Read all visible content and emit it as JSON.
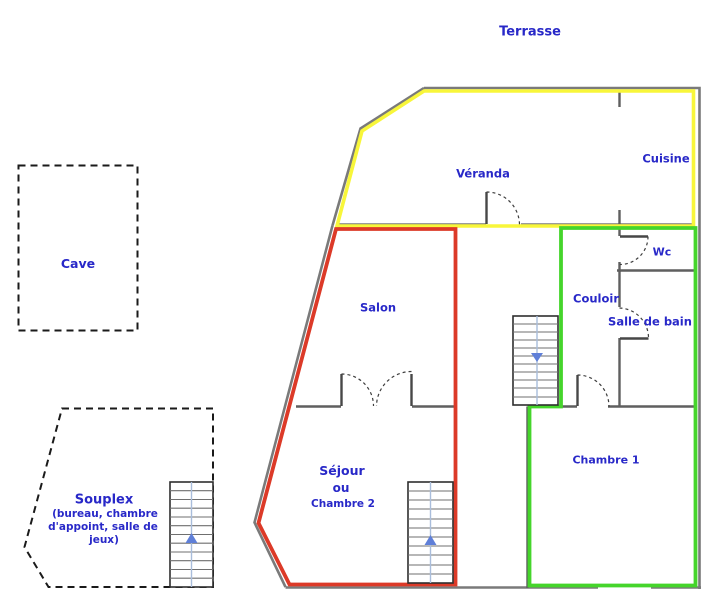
{
  "title": "Plan d'étage (floor plan)",
  "colors": {
    "label_blue": "#2828c8",
    "zone_yellow": "#f8f63a",
    "zone_red": "#dc3a28",
    "zone_green": "#45d52b",
    "wall_gray": "#7a7a7a",
    "dash_black": "#1a1a1a",
    "arrow_blue": "#5f7fd8"
  },
  "labels": {
    "terrasse": "Terrasse",
    "cave": "Cave",
    "veranda": "Véranda",
    "cuisine": "Cuisine",
    "wc": "Wc",
    "couloir": "Couloir",
    "salle_de_bain": "Salle de bain",
    "salon": "Salon",
    "sejour_line1": "Séjour",
    "sejour_line2": "ou",
    "sejour_line3": "Chambre 2",
    "chambre1": "Chambre 1",
    "souplex_title": "Souplex",
    "souplex_line1": "(bureau, chambre",
    "souplex_line2": "d'appoint, salle de",
    "souplex_line3": "jeux)"
  },
  "stairs": [
    {
      "location": "entry-hall",
      "arrow_icon": "arrow-down-icon",
      "direction": "down"
    },
    {
      "location": "sejour",
      "arrow_icon": "arrow-up-icon",
      "direction": "up"
    },
    {
      "location": "souplex",
      "arrow_icon": "arrow-up-icon",
      "direction": "up"
    }
  ],
  "zones": [
    {
      "color_key": "zone_yellow",
      "rooms": [
        "Véranda",
        "Cuisine"
      ]
    },
    {
      "color_key": "zone_red",
      "rooms": [
        "Salon",
        "Séjour ou Chambre 2"
      ]
    },
    {
      "color_key": "zone_green",
      "rooms": [
        "Wc",
        "Couloir",
        "Salle de bain",
        "Chambre 1"
      ]
    },
    {
      "color_key": "dash_black",
      "rooms": [
        "Cave",
        "Souplex"
      ]
    }
  ]
}
